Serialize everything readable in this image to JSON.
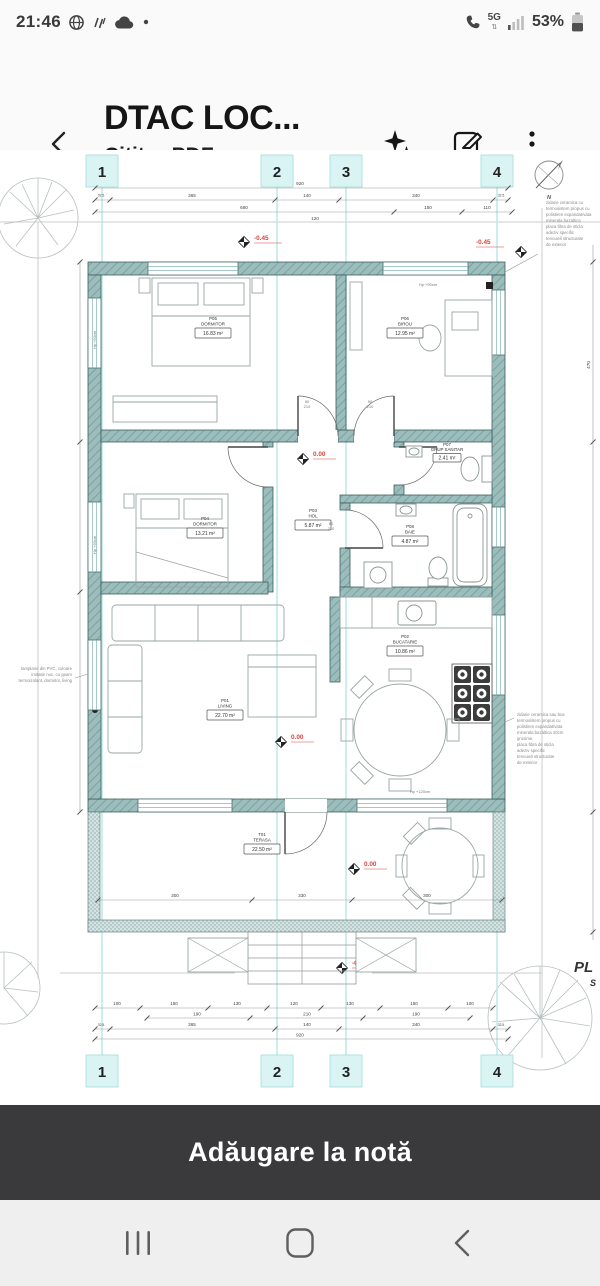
{
  "status_bar": {
    "time": "21:46",
    "network_label": "5G",
    "battery_percent": "53%"
  },
  "header": {
    "title": "DTAC LOC...",
    "subtitle": "Cititor PDF"
  },
  "plan": {
    "grid_labels_top": [
      "1",
      "2",
      "3",
      "4"
    ],
    "grid_labels_bottom": [
      "1",
      "2",
      "3",
      "4"
    ],
    "north_label": "N",
    "sheet_label": "PL",
    "sheet_label2": "S",
    "rooms": [
      {
        "id": "P05",
        "name": "DORMITOR",
        "area": "16.83 m²"
      },
      {
        "id": "P06",
        "name": "BIROU",
        "area": "12.95 m²"
      },
      {
        "id": "P07",
        "name": "GRUP SANITAR",
        "area": "2.41 m²"
      },
      {
        "id": "P03",
        "name": "HOL",
        "area": "5.87 m²"
      },
      {
        "id": "P08",
        "name": "BAIE",
        "area": "4.87 m²"
      },
      {
        "id": "P04",
        "name": "DORMITOR",
        "area": "13.21 m²"
      },
      {
        "id": "P01",
        "name": "LIVING",
        "area": "22.70 m²"
      },
      {
        "id": "P02",
        "name": "BUCATARIE",
        "area": "10.86 m²"
      },
      {
        "id": "T01",
        "name": "TERASA",
        "area": "22.50 m²"
      }
    ],
    "levels": {
      "top_left": "-0.45",
      "top_right": "-0.45",
      "hall": "0.00",
      "living": "0.00",
      "terrace": "0.00",
      "bottom": "-0.45"
    },
    "dims_top": {
      "overall": "920",
      "chain1": [
        "32.5",
        "365",
        "140",
        "340",
        "32.5"
      ],
      "chain2": [
        "660",
        "150",
        "110"
      ],
      "extra": "120"
    },
    "dims_bottom": {
      "chain1": [
        "100",
        "150",
        "130",
        "120",
        "130",
        "150",
        "100"
      ],
      "chain2": [
        "190",
        "210",
        "190"
      ],
      "chain3": [
        "32.5",
        "365",
        "140",
        "340",
        "32.5"
      ],
      "overall": "920"
    },
    "dims_terrace": [
      "300",
      "330",
      "300"
    ],
    "dim_right": "470",
    "door_dims": {
      "a_w": "90",
      "a_h": "210",
      "b_w": "90",
      "b_h": "210",
      "c_w": "80",
      "c_h": "210"
    },
    "window_notes": {
      "top": "Hp +90cm",
      "left1": "Hp +90cm",
      "left2": "Hp +90cm",
      "kitchen": "Hp +120cm"
    },
    "notes_right_top": [
      "zidarie ceramica cu",
      "termosistem propus cu",
      "polistiren expandat/vata",
      "minerala bazaltica",
      "placa fibra de sticla",
      "adeziv specific",
      "tencuieli structurate",
      "de exterior"
    ],
    "notes_right_mid": [
      "zidarie ceramica sau bca",
      "termosistem propus cu",
      "polistiren expandat/vata",
      "minerala bazaltica 10cm",
      "grosime,",
      "placa fibra de sticla",
      "adeziv specific",
      "tencuieli structurate",
      "de exterior"
    ],
    "notes_left": [
      "tamplarie din PVC, culoare",
      "imitatie nuc, cu geam",
      "termoizolant, dormitor, living"
    ]
  },
  "note_bar": {
    "label": "Adăugare la notă"
  }
}
